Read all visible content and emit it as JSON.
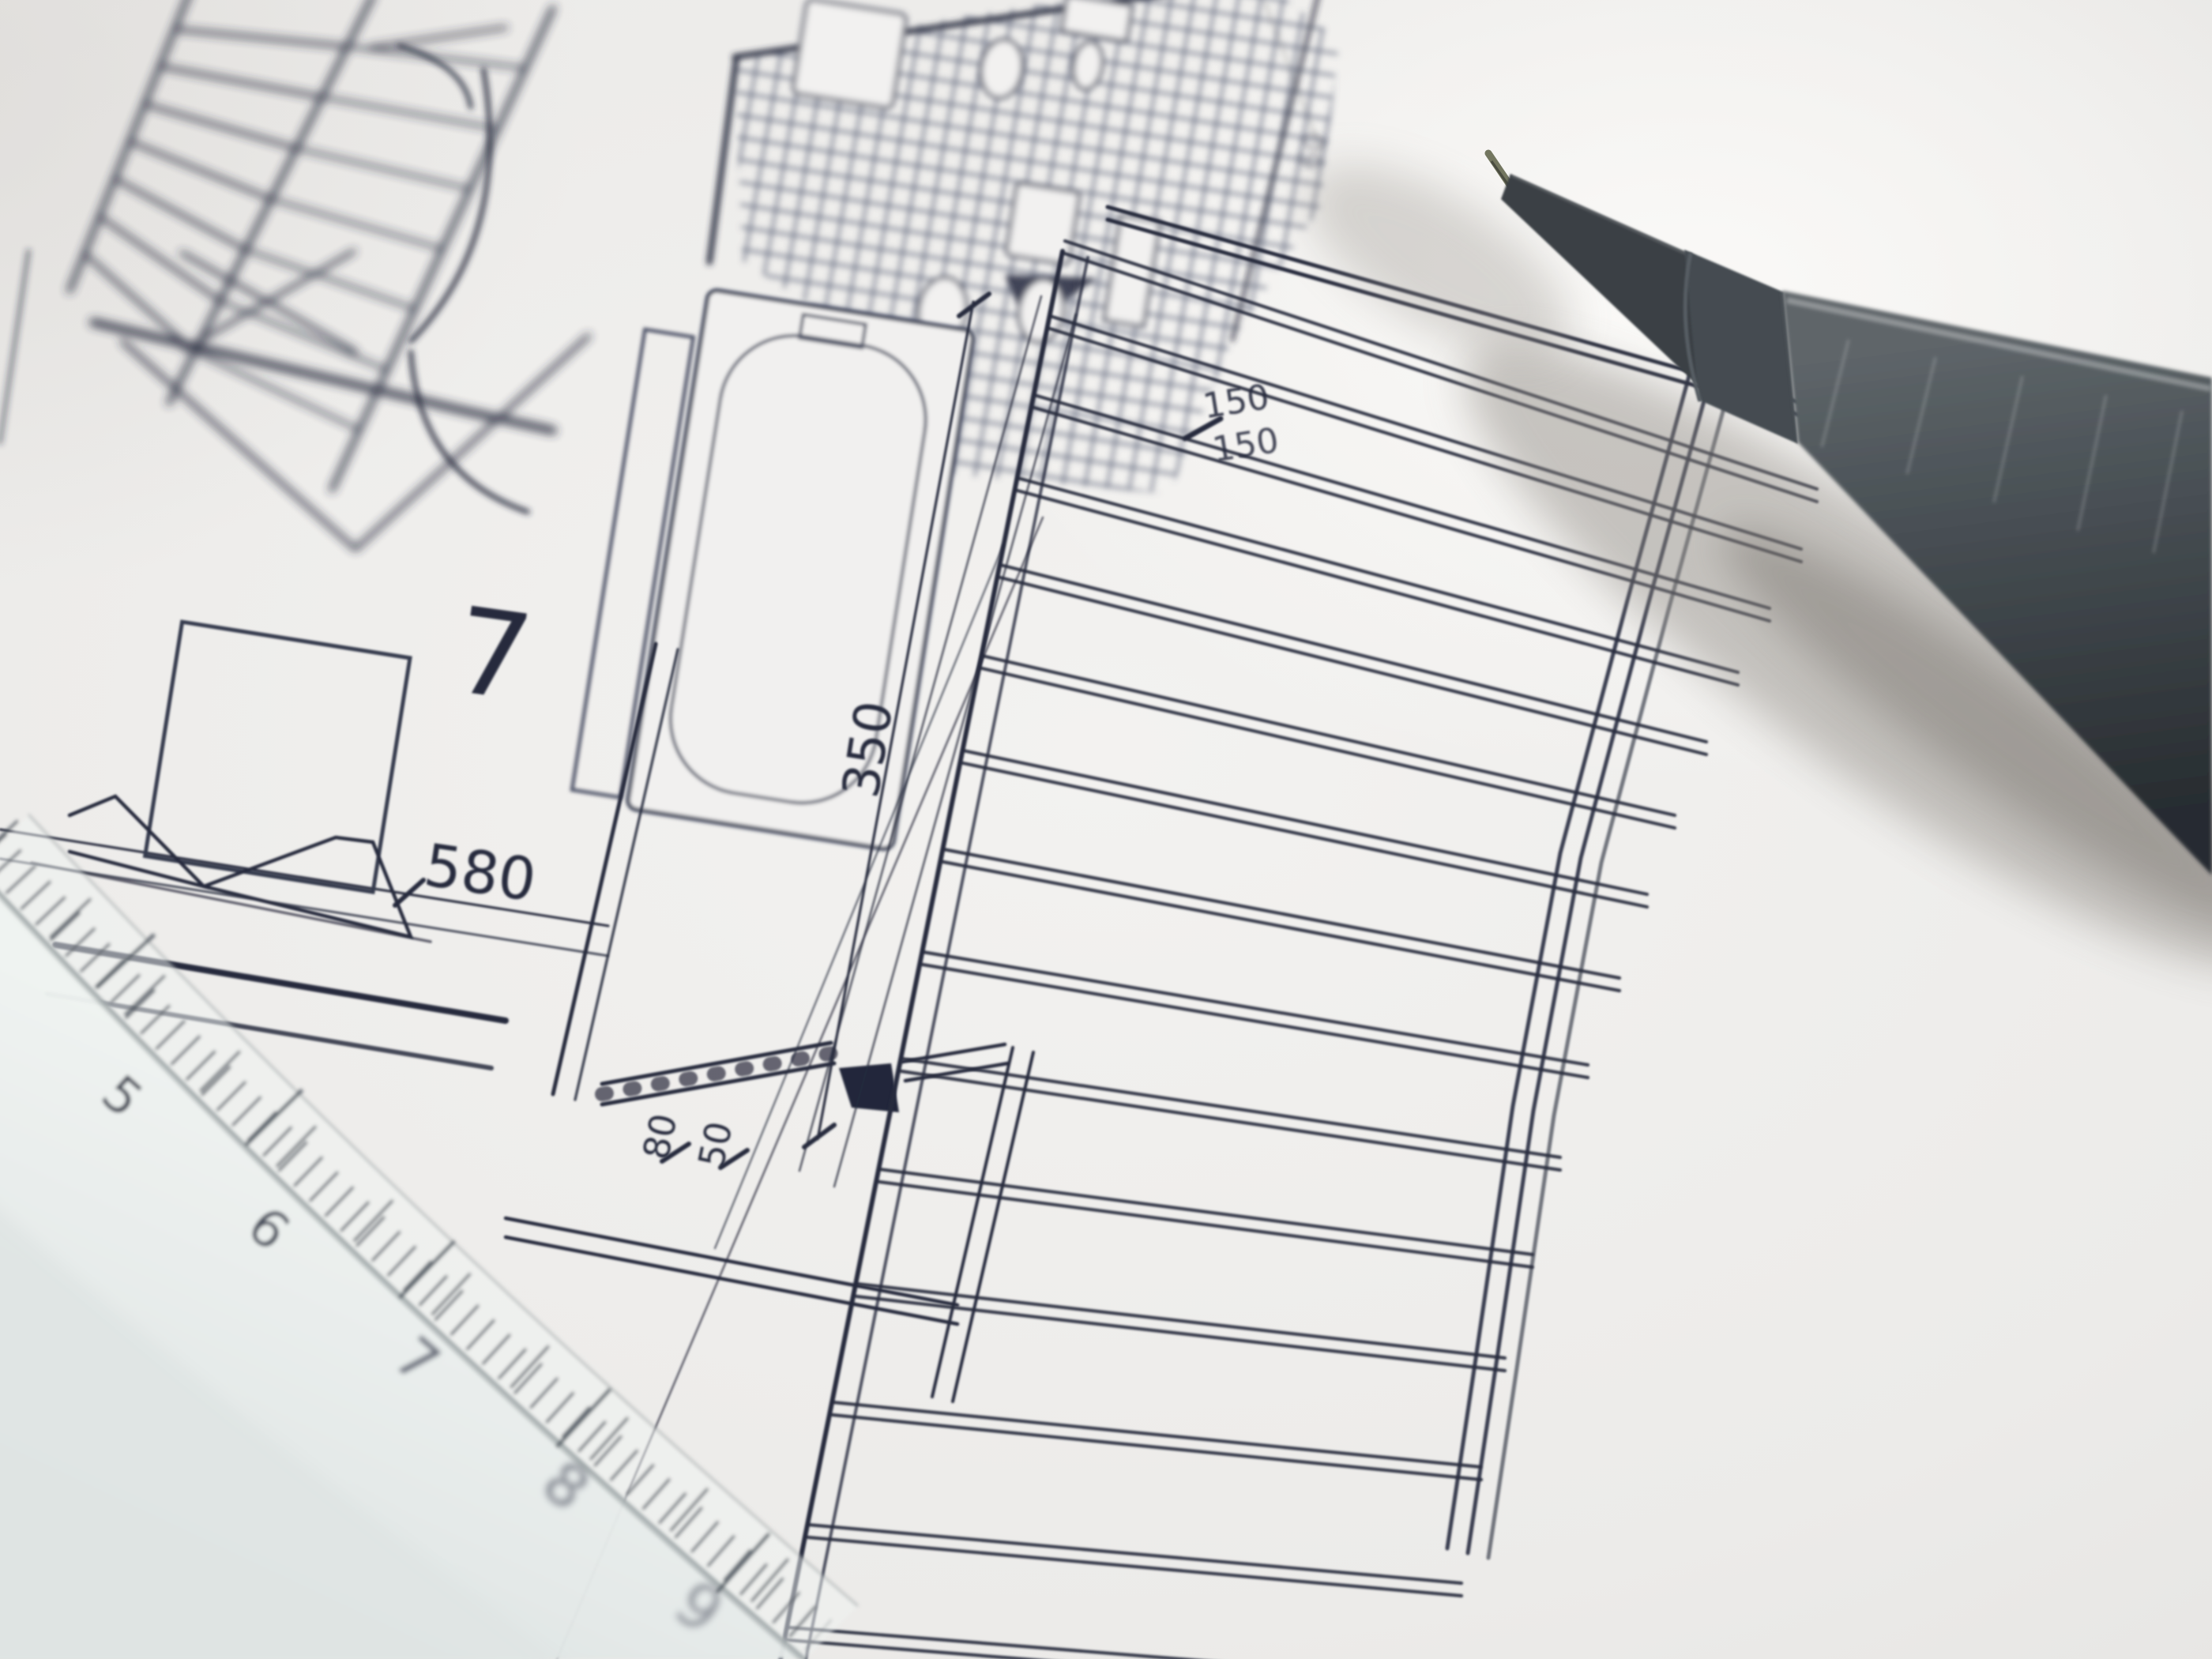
{
  "plan": {
    "room_number": "7",
    "dim_width": "580",
    "dim_height": "350",
    "dim_small_top": "80",
    "dim_small_bottom": "50",
    "dim_joist_top": "150",
    "dim_joist_bottom": "150",
    "dim_faint": "60"
  },
  "ruler": {
    "marks": [
      "5",
      "6",
      "7",
      "8",
      "9"
    ]
  }
}
